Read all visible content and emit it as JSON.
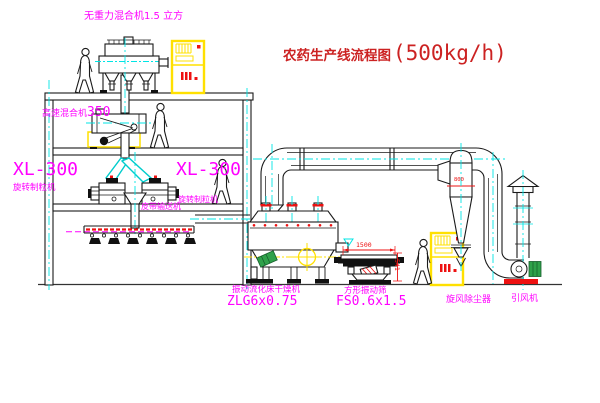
{
  "title": {
    "name": "农药生产线流程图",
    "capacity": "(500kg/h)"
  },
  "labels": {
    "top_mixer": "无重力混合机1.5 立方",
    "high_speed_mixer_name": "高速混合机",
    "high_speed_mixer_model": "350",
    "granulator_left_model": "XL-300",
    "granulator_left_name": "旋转制粒机",
    "granulator_right_model": "XL-300",
    "granulator_right_name": "旋转制粒机",
    "belt_conveyor": "皮带输送机",
    "dryer_name": "振动流化床干燥机",
    "dryer_model": "ZLG6x0.75",
    "sieve_name": "方形振动筛",
    "sieve_model": "FS0.6x1.5",
    "cyclone": "旋风除尘器",
    "fan": "引风机"
  },
  "dimensions": {
    "sieve_width": "1500",
    "sieve_height": "541",
    "cyclone_outlet": "800"
  },
  "colors": {
    "label_magenta": "#ff00ff",
    "title_red": "#cc2222",
    "centerline_cyan": "#00e5e5",
    "cabinet_yellow": "#ffe000",
    "dimension_red": "#ee1111",
    "motor_green": "#2fa14a"
  }
}
